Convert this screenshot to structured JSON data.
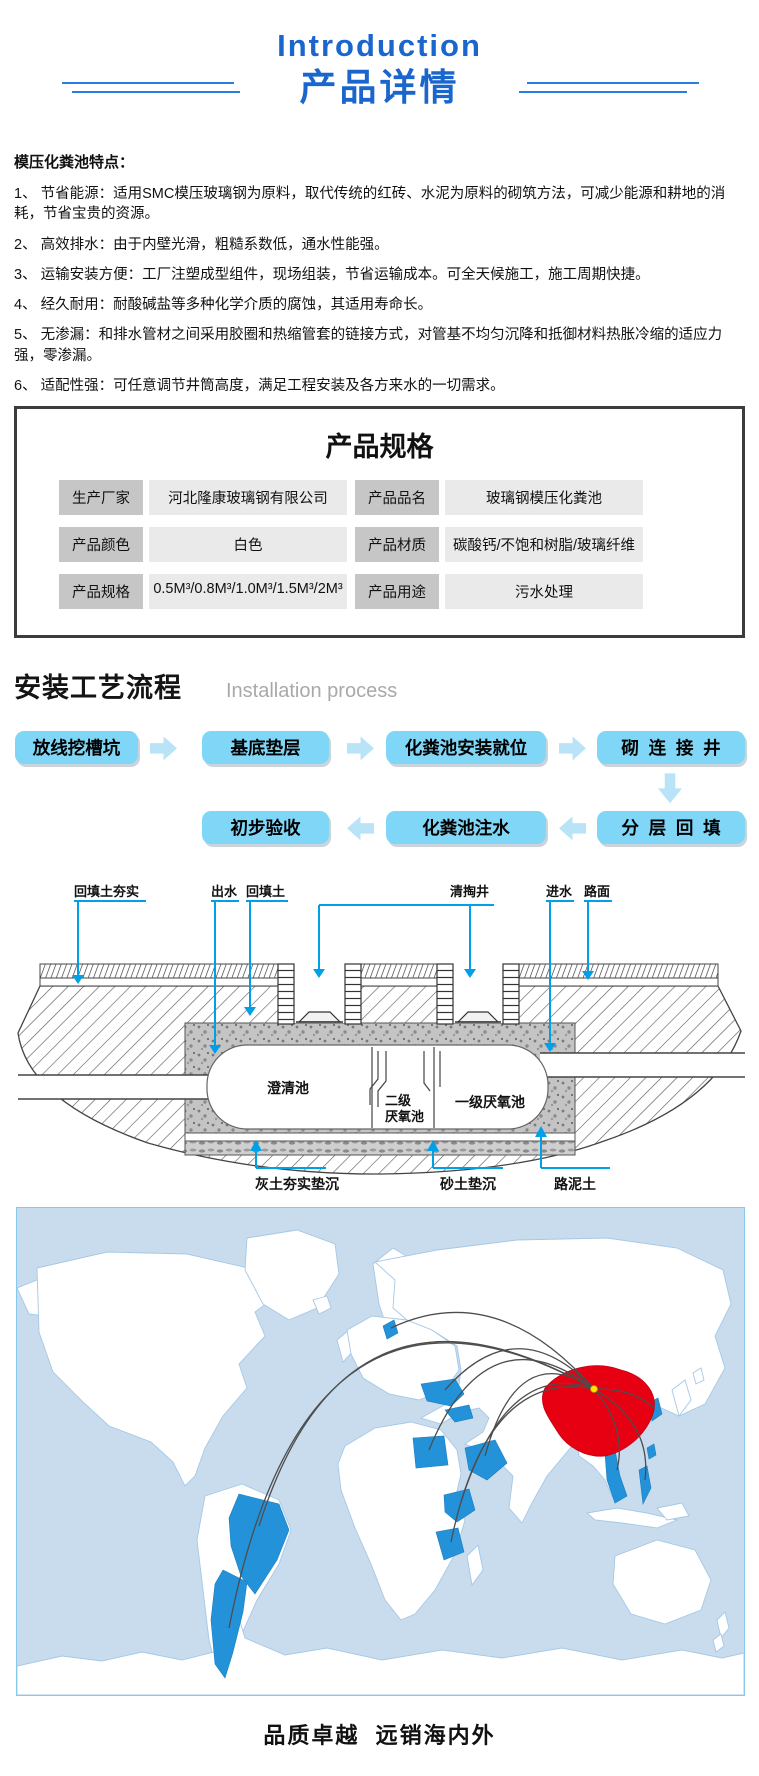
{
  "header": {
    "title_en": "Introduction",
    "title_zh": "产品详情"
  },
  "features": {
    "heading": "模压化粪池特点：",
    "items": [
      "1、 节省能源：适用SMC模压玻璃钢为原料，取代传统的红砖、水泥为原料的砌筑方法，可减少能源和耕地的消耗，节省宝贵的资源。",
      "2、 高效排水：由于内壁光滑，粗糙系数低，通水性能强。",
      "3、 运输安装方便：工厂注塑成型组件，现场组装，节省运输成本。可全天候施工，施工周期快捷。",
      "4、 经久耐用：耐酸碱盐等多种化学介质的腐蚀，其适用寿命长。",
      "5、 无渗漏：和排水管材之间采用胶圈和热缩管套的链接方式，对管基不均匀沉降和抵御材料热胀冷缩的适应力强，零渗漏。",
      "6、 适配性强：可任意调节井筒高度，满足工程安装及各方来水的一切需求。"
    ]
  },
  "specs": {
    "title": "产品规格",
    "rows": [
      {
        "label_left": "生产厂家",
        "value_left": "河北隆康玻璃钢有限公司",
        "label_right": "产品品名",
        "value_right": "玻璃钢模压化粪池"
      },
      {
        "label_left": "产品颜色",
        "value_left": "白色",
        "label_right": "产品材质",
        "value_right": "碳酸钙/不饱和树脂/玻璃纤维"
      },
      {
        "label_left": "产品规格",
        "value_left": "0.5M³/0.8M³/1.0M³/1.5M³/2M³",
        "label_right": "产品用途",
        "value_right": "污水处理"
      }
    ]
  },
  "process": {
    "heading_zh": "安装工艺流程",
    "heading_en": "Installation process",
    "row1": [
      "放线挖槽坑",
      "基底垫层",
      "化粪池安装就位",
      "砌  连  接  井"
    ],
    "row2": [
      "初步验收",
      "化粪池注水",
      "分  层  回  填"
    ]
  },
  "diagram": {
    "labels_top": [
      "回填土夯实",
      "出水",
      "回填土",
      "清掏井",
      "进水",
      "路面"
    ],
    "labels_inner": [
      "澄清池",
      "二级",
      "厌氧池",
      "一级厌氧池"
    ],
    "labels_bottom": [
      "灰土夯实垫沉",
      "砂土垫沉",
      "路泥土"
    ],
    "leader_color": "#00a0e9"
  },
  "map": {
    "colors": {
      "ocean": "#c9dcee",
      "land": "#ffffff",
      "land_border": "#a5c8e6",
      "highlight_country": "#2492d8",
      "china": "#e60012",
      "route_line": "#4d4d4d",
      "origin_dot": "#ffe400"
    }
  },
  "footer": {
    "caption": "品质卓越  远销海内外"
  },
  "colors": {
    "header_blue": "#1b66cc",
    "flow_box": "#7fd6f6",
    "flow_arrow": "#b9e4f8",
    "diagram_leader": "#00a0e9"
  }
}
